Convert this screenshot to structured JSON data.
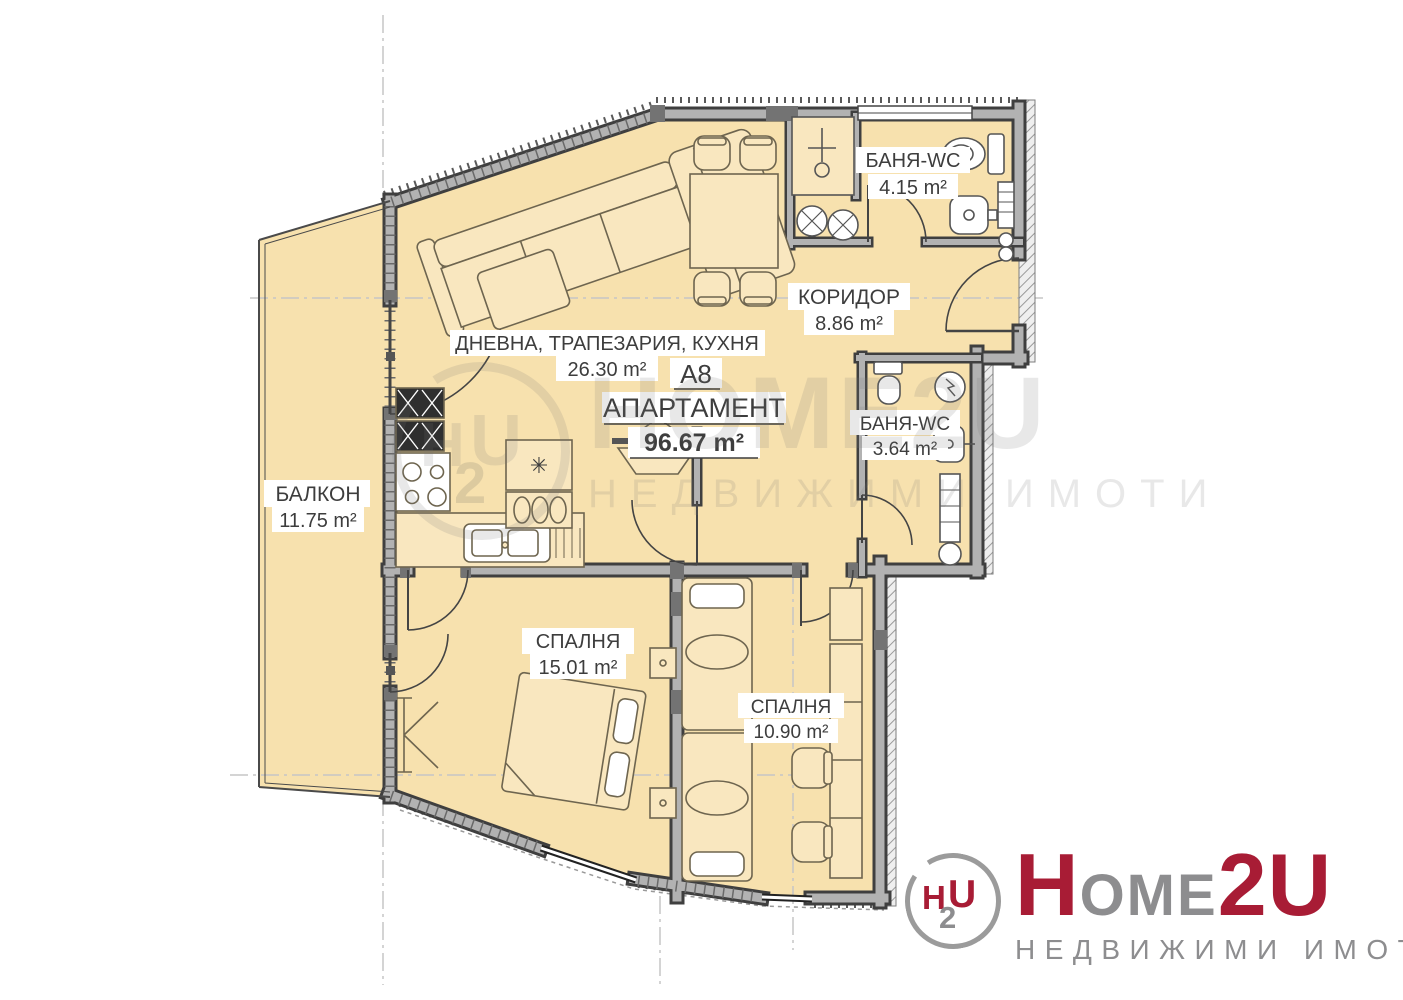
{
  "plan": {
    "apartment_id": "A8",
    "apartment_label": "АПАРТАМЕНТ",
    "apartment_area": "96.67 m²",
    "rooms": {
      "living": {
        "name": "ДНЕВНА, ТРАПЕЗАРИЯ, КУХНЯ",
        "area": "26.30 m²"
      },
      "balcony": {
        "name": "БАЛКОН",
        "area": "11.75 m²"
      },
      "corridor": {
        "name": "КОРИДОР",
        "area": "8.86 m²"
      },
      "bath1": {
        "name": "БАНЯ-WC",
        "area": "4.15 m²"
      },
      "bath2": {
        "name": "БАНЯ-WC",
        "area": "3.64 m²"
      },
      "bedroom1": {
        "name": "СПАЛНЯ",
        "area": "15.01 m²"
      },
      "bedroom2": {
        "name": "СПАЛНЯ",
        "area": "10.90 m²"
      }
    },
    "symbols": {
      "fridge": "✳"
    }
  },
  "watermark": {
    "word": "HOME2U",
    "tagline": "НЕДВИЖИМИ ИМОТИ",
    "emblem": {
      "h": "H",
      "u": "U",
      "two": "2"
    }
  },
  "logo": {
    "h": "H",
    "ome": "OME",
    "two_u": "2U",
    "tagline": "НЕДВИЖИМИ   ИМОТИ",
    "emblem": {
      "h": "H",
      "u": "U",
      "two": "2"
    }
  },
  "colors": {
    "floor": "#f7e1ae",
    "wall_fill": "#b2b2b2",
    "wall_edge": "#3f3f3f",
    "brand_red": "#a81c35",
    "brand_gray": "#8d8d8f"
  }
}
